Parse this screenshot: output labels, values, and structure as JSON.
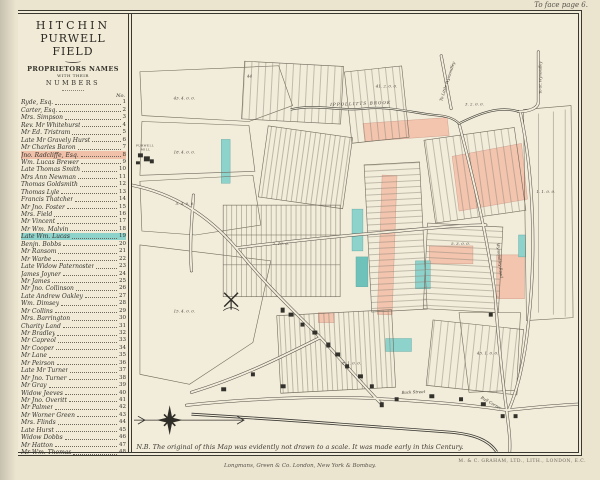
{
  "page": {
    "annotation_top_right": "To face page 6.",
    "note": "N.B. The original of this Map was evidently not drawn to a scale. It was made early in this Century.",
    "publisher_imprint": "Longmans, Green & Co. London, New York & Bombay.",
    "printer_imprint": "M. & C. GRAHAM, LTD., LITH., LONDON, E.C."
  },
  "legend": {
    "title_line1": "HITCHIN",
    "title_line2": "PURWELL FIELD",
    "subtitle_line1": "PROPRIETORS NAMES",
    "subtitle_line2": "WITH THEIR",
    "subtitle_line3": "NUMBERS",
    "column_header": "No.",
    "proprietors": [
      {
        "name": "Ryde, Esq.",
        "no": 1,
        "highlight": null
      },
      {
        "name": "Carter, Esq.",
        "no": 2,
        "highlight": null
      },
      {
        "name": "Mrs. Simpson",
        "no": 3,
        "highlight": null
      },
      {
        "name": "Rev. Mr Whitehurst",
        "no": 4,
        "highlight": null
      },
      {
        "name": "Mr Ed. Tristram",
        "no": 5,
        "highlight": null
      },
      {
        "name": "Late Mr Gravely Hurst",
        "no": 6,
        "highlight": null
      },
      {
        "name": "Mr Charles Baron",
        "no": 7,
        "highlight": null
      },
      {
        "name": "Jno. Radcliffe, Esq.",
        "no": 8,
        "highlight": "pink"
      },
      {
        "name": "Wm. Lucas Brewer",
        "no": 9,
        "highlight": null
      },
      {
        "name": "Late Thomas Smith",
        "no": 10,
        "highlight": null
      },
      {
        "name": "Mrs Ann Newman",
        "no": 11,
        "highlight": null
      },
      {
        "name": "Thomas Goldsmith",
        "no": 12,
        "highlight": null
      },
      {
        "name": "Thomas Lyle",
        "no": 13,
        "highlight": null
      },
      {
        "name": "Francis Thatcher",
        "no": 14,
        "highlight": null
      },
      {
        "name": "Mr Jno. Foster",
        "no": 15,
        "highlight": null
      },
      {
        "name": "Mrs. Field",
        "no": 16,
        "highlight": null
      },
      {
        "name": "Mr Vincent",
        "no": 17,
        "highlight": null
      },
      {
        "name": "Mr Wm. Malvin",
        "no": 18,
        "highlight": null
      },
      {
        "name": "Late Wm. Lucas",
        "no": 19,
        "highlight": "cyan"
      },
      {
        "name": "Benjn. Bobbs",
        "no": 20,
        "highlight": null
      },
      {
        "name": "Mr Ransom",
        "no": 21,
        "highlight": null
      },
      {
        "name": "Mr Warbe",
        "no": 22,
        "highlight": null
      },
      {
        "name": "Late Widow Paternoster",
        "no": 23,
        "highlight": null
      },
      {
        "name": "James Joyner",
        "no": 24,
        "highlight": null
      },
      {
        "name": "Mr James",
        "no": 25,
        "highlight": null
      },
      {
        "name": "Mr Jno. Collinson",
        "no": 26,
        "highlight": null
      },
      {
        "name": "Late Andrew Oakley",
        "no": 27,
        "highlight": null
      },
      {
        "name": "Wm. Dimsey",
        "no": 28,
        "highlight": null
      },
      {
        "name": "Mr Collins",
        "no": 29,
        "highlight": null
      },
      {
        "name": "Mrs. Barrington",
        "no": 30,
        "highlight": null
      },
      {
        "name": "Charity Land",
        "no": 31,
        "highlight": null
      },
      {
        "name": "Mr Bradley",
        "no": 32,
        "highlight": null
      },
      {
        "name": "Mr Capreol",
        "no": 33,
        "highlight": null
      },
      {
        "name": "Mr Cooper",
        "no": 34,
        "highlight": null
      },
      {
        "name": "Mr Lane",
        "no": 35,
        "highlight": null
      },
      {
        "name": "Mr Peirson",
        "no": 36,
        "highlight": null
      },
      {
        "name": "Late Mr Turner",
        "no": 37,
        "highlight": null
      },
      {
        "name": "Mr Jno. Turner",
        "no": 38,
        "highlight": null
      },
      {
        "name": "Mr Gray",
        "no": 39,
        "highlight": null
      },
      {
        "name": "Widow Jeeves",
        "no": 40,
        "highlight": null
      },
      {
        "name": "Mr Jno. Overitt",
        "no": 41,
        "highlight": null
      },
      {
        "name": "Mr Palmer",
        "no": 42,
        "highlight": null
      },
      {
        "name": "Mr Worner Green",
        "no": 43,
        "highlight": null
      },
      {
        "name": "Mrs. Flinds",
        "no": 44,
        "highlight": null
      },
      {
        "name": "Late Hurst",
        "no": 45,
        "highlight": null
      },
      {
        "name": "Widow Dobbs",
        "no": 46,
        "highlight": null
      },
      {
        "name": "Mr Hatton",
        "no": 47,
        "highlight": null
      },
      {
        "name": "Mr Wm. Thomas",
        "no": 48,
        "highlight": null
      }
    ]
  },
  "map": {
    "labels": {
      "purwell_mill_1": "PURWELL",
      "purwell_mill_2": "MILL",
      "ippollitts_brook": "IPPOLLITTS BROOK",
      "to_little_wymondley": "To Little Wymondley",
      "to_gt_wymondley": "To Gt. Wymondley",
      "wymondley_road": "Wymondley Road",
      "back_street": "Back Street",
      "bull_corner": "Bull Corner"
    },
    "field_labels": [
      "43. 4. 0. 0.",
      "18. 4. 0. 0.",
      "5. 4. 0. 0.",
      "15. 4. 0. 0.",
      "44",
      "41. 2. 0. 0.",
      "2. 10. 0.",
      "5. 3. 0. 0.",
      "1. 1. 0. 0.",
      "3. 2. 0. 0.",
      "8. 1. 0. 0.",
      "43. 1. 0. 0."
    ],
    "colors": {
      "highlight_pink": "#f0c0a8",
      "highlight_cyan": "#8ed2cc",
      "paper": "#f1ebd9",
      "ink": "#3a382f"
    }
  }
}
